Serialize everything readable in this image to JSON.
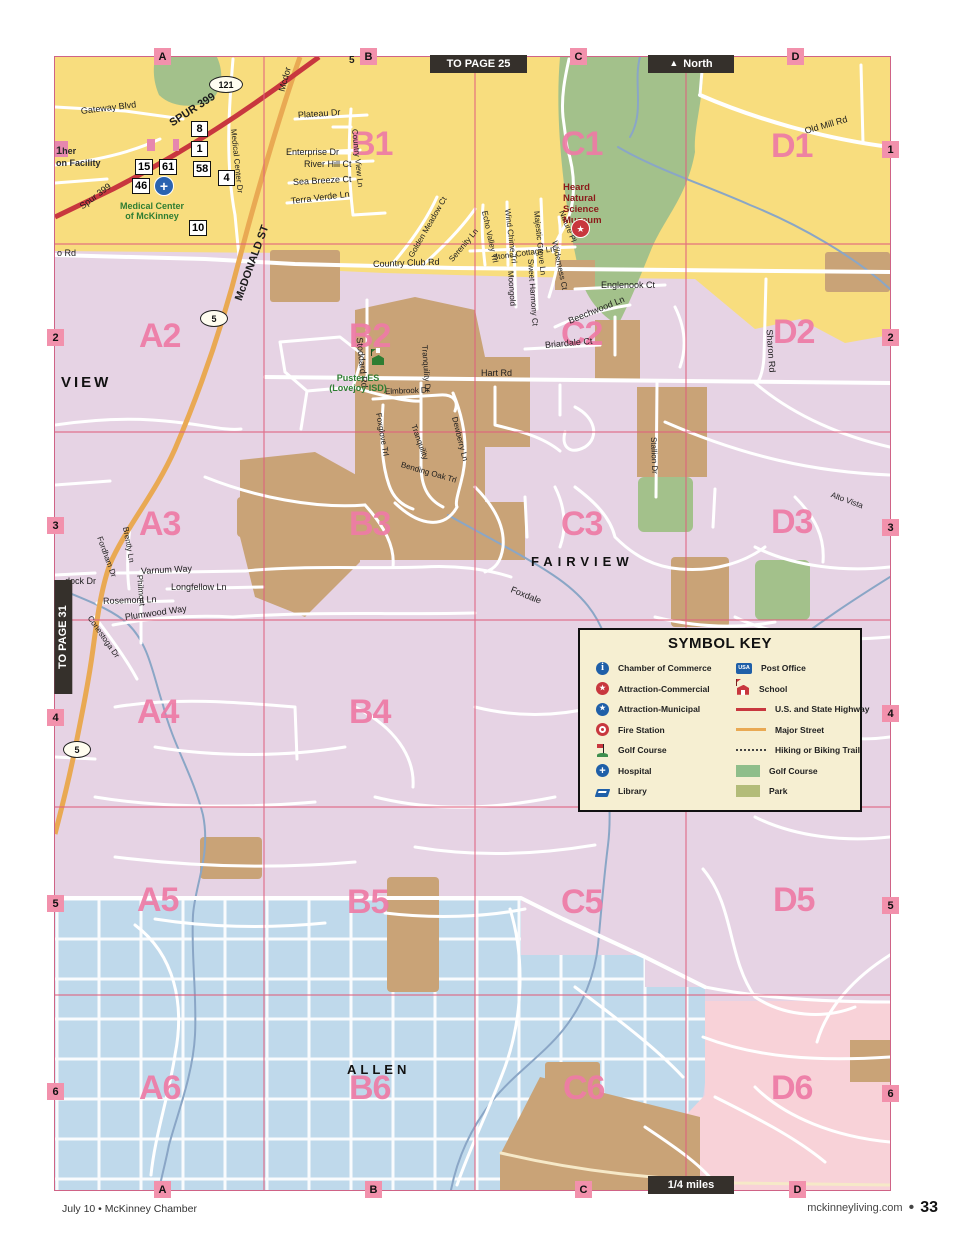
{
  "nav": {
    "to_page_top": "TO PAGE 25",
    "north_arrow": "▲",
    "north_label": "North",
    "to_page_left": "TO PAGE 31",
    "scale_label": "1/4 miles"
  },
  "footer": {
    "left": "July 10 • McKinney Chamber",
    "site": "mckinneyliving.com",
    "bullet": "•",
    "page": "33"
  },
  "colors": {
    "yellow": "#F8DD7E",
    "lavender": "#E6D3E4",
    "blue": "#BFD9EB",
    "pink": "#F8D2D8",
    "tan": "#C9A377",
    "green": "#A3C18B",
    "highway_red": "#C8373E",
    "street_orange": "#E9A953",
    "grid_pink": "#F291AC",
    "cell_label": "#EE7BA6",
    "creek": "#8AA6C6",
    "grid_line": "#E0607E"
  },
  "grid": {
    "top_letters": [
      {
        "t": "A",
        "x": 99
      },
      {
        "t": "B",
        "x": 305
      },
      {
        "t": "C",
        "x": 515
      },
      {
        "t": "D",
        "x": 732
      }
    ],
    "bottom_letters": [
      {
        "t": "A",
        "x": 99
      },
      {
        "t": "B",
        "x": 310
      },
      {
        "t": "C",
        "x": 520
      },
      {
        "t": "D",
        "x": 734
      }
    ],
    "left_numbers": [
      {
        "t": "2",
        "y": 272
      },
      {
        "t": "3",
        "y": 460
      },
      {
        "t": "4",
        "y": 652
      },
      {
        "t": "5",
        "y": 838
      },
      {
        "t": "6",
        "y": 1026
      }
    ],
    "right_numbers": [
      {
        "t": "1",
        "y": 84
      },
      {
        "t": "2",
        "y": 272
      },
      {
        "t": "3",
        "y": 462
      },
      {
        "t": "4",
        "y": 648
      },
      {
        "t": "5",
        "y": 840
      },
      {
        "t": "6",
        "y": 1028
      }
    ]
  },
  "cells": [
    {
      "t": "B1",
      "x": 296,
      "y": 70
    },
    {
      "t": "C1",
      "x": 506,
      "y": 70
    },
    {
      "t": "D1",
      "x": 716,
      "y": 72
    },
    {
      "t": "A2",
      "x": 84,
      "y": 262
    },
    {
      "t": "B2",
      "x": 294,
      "y": 262
    },
    {
      "t": "C2",
      "x": 506,
      "y": 260
    },
    {
      "t": "D2",
      "x": 718,
      "y": 258
    },
    {
      "t": "A3",
      "x": 84,
      "y": 450
    },
    {
      "t": "B3",
      "x": 294,
      "y": 450
    },
    {
      "t": "C3",
      "x": 506,
      "y": 450
    },
    {
      "t": "D3",
      "x": 716,
      "y": 448
    },
    {
      "t": "A4",
      "x": 82,
      "y": 638
    },
    {
      "t": "B4",
      "x": 294,
      "y": 638
    },
    {
      "t": "A5",
      "x": 82,
      "y": 826
    },
    {
      "t": "B5",
      "x": 292,
      "y": 828
    },
    {
      "t": "C5",
      "x": 506,
      "y": 828
    },
    {
      "t": "D5",
      "x": 718,
      "y": 826
    },
    {
      "t": "A6",
      "x": 84,
      "y": 1014
    },
    {
      "t": "B6",
      "x": 294,
      "y": 1014
    },
    {
      "t": "C6",
      "x": 508,
      "y": 1014
    },
    {
      "t": "D6",
      "x": 716,
      "y": 1014
    }
  ],
  "cities": [
    {
      "t": "VIEW",
      "x": 6,
      "y": 318,
      "s": 15,
      "ls": 3
    },
    {
      "t": "FAIRVIEW",
      "x": 476,
      "y": 498,
      "s": 13,
      "ls": 5
    },
    {
      "t": "ALLEN",
      "x": 292,
      "y": 1006,
      "s": 13,
      "ls": 4
    }
  ],
  "streets": [
    {
      "t": "Gateway Blvd",
      "x": 26,
      "y": 50,
      "r": -7,
      "s": 9
    },
    {
      "t": "Spur 399",
      "x": 26,
      "y": 146,
      "r": -37,
      "s": 9
    },
    {
      "t": "SPUR 399",
      "x": 116,
      "y": 62,
      "r": -33,
      "s": 11,
      "b": 1
    },
    {
      "t": "Mcdor",
      "x": 227,
      "y": 30,
      "r": -75,
      "s": 9
    },
    {
      "t": "Plateau Dr",
      "x": 243,
      "y": 54,
      "r": -4,
      "s": 9
    },
    {
      "t": "Enterprise Dr",
      "x": 231,
      "y": 91,
      "s": 9
    },
    {
      "t": "River Hill Ct",
      "x": 249,
      "y": 103,
      "s": 9
    },
    {
      "t": "Sea Breeze Ct",
      "x": 238,
      "y": 121,
      "r": -3,
      "s": 9
    },
    {
      "t": "Terra Verde Ln",
      "x": 236,
      "y": 140,
      "r": -7,
      "s": 9
    },
    {
      "t": "Country View Ln",
      "x": 299,
      "y": 68,
      "r": 84
    },
    {
      "t": "Golden Meadow Ct",
      "x": 356,
      "y": 196,
      "r": -60
    },
    {
      "t": "Serenity Ln",
      "x": 396,
      "y": 200,
      "r": -50
    },
    {
      "t": "Echo Valley Trl",
      "x": 429,
      "y": 150,
      "r": 78
    },
    {
      "t": "Stone Cottage Ln",
      "x": 438,
      "y": 197,
      "r": -8
    },
    {
      "t": "Wind Chime Trl",
      "x": 452,
      "y": 148,
      "r": 83
    },
    {
      "t": "Moongold",
      "x": 455,
      "y": 210,
      "r": 86
    },
    {
      "t": "Sweet Harmony Ct",
      "x": 475,
      "y": 198,
      "r": 86
    },
    {
      "t": "Majestic Grove Ln",
      "x": 481,
      "y": 150,
      "r": 84
    },
    {
      "t": "Wilderness Ct",
      "x": 499,
      "y": 180,
      "r": 78
    },
    {
      "t": "Nature Pl",
      "x": 506,
      "y": 150,
      "r": 68
    },
    {
      "t": "Country Club Rd",
      "x": 318,
      "y": 203,
      "r": -2,
      "s": 9
    },
    {
      "t": "o Rd",
      "x": 2,
      "y": 192,
      "s": 9
    },
    {
      "t": "Englenook Ct",
      "x": 546,
      "y": 224,
      "s": 9
    },
    {
      "t": "Beechwood Ln",
      "x": 514,
      "y": 260,
      "r": -22,
      "s": 9
    },
    {
      "t": "Briardale Ct",
      "x": 490,
      "y": 284,
      "r": -5,
      "s": 9
    },
    {
      "t": "Old Mill Rd",
      "x": 750,
      "y": 70,
      "r": -16,
      "s": 9
    },
    {
      "t": "Sharon Rd",
      "x": 714,
      "y": 268,
      "r": 86,
      "s": 9
    },
    {
      "t": "Stoddard Rd",
      "x": 304,
      "y": 276,
      "r": 84,
      "s": 9
    },
    {
      "t": "Hart Rd",
      "x": 426,
      "y": 312,
      "s": 9
    },
    {
      "t": "Elmbrook Dr",
      "x": 330,
      "y": 331,
      "r": -2
    },
    {
      "t": "Tranquility Dr",
      "x": 369,
      "y": 284,
      "r": 86
    },
    {
      "t": "Tranquility",
      "x": 358,
      "y": 364,
      "r": 70
    },
    {
      "t": "Foxglove Trl",
      "x": 323,
      "y": 352,
      "r": 80
    },
    {
      "t": "Bending Oak Trl",
      "x": 346,
      "y": 404,
      "r": 16
    },
    {
      "t": "Dewberry Ln",
      "x": 399,
      "y": 356,
      "r": 76
    },
    {
      "t": "Stallion Dr",
      "x": 598,
      "y": 376,
      "r": 88
    },
    {
      "t": "Alto Vista",
      "x": 776,
      "y": 434,
      "r": 20
    },
    {
      "t": "Fordham Dr",
      "x": 44,
      "y": 476,
      "r": 70
    },
    {
      "t": "Brently Ln",
      "x": 70,
      "y": 466,
      "r": 80
    },
    {
      "t": "Varnum Way",
      "x": 86,
      "y": 510,
      "r": -3,
      "s": 9
    },
    {
      "t": "dock Dr",
      "x": 10,
      "y": 520,
      "s": 9
    },
    {
      "t": "Longfellow Ln",
      "x": 116,
      "y": 526,
      "s": 9
    },
    {
      "t": "Rosemont Ln",
      "x": 48,
      "y": 540,
      "r": -2,
      "s": 9
    },
    {
      "t": "Philmont",
      "x": 84,
      "y": 514,
      "r": 85
    },
    {
      "t": "Conestoga Dr",
      "x": 34,
      "y": 556,
      "r": 55
    },
    {
      "t": "Plumwood Way",
      "x": 70,
      "y": 556,
      "r": -8,
      "s": 9
    },
    {
      "t": "Foxdale",
      "x": 456,
      "y": 528,
      "r": 22,
      "s": 9
    },
    {
      "t": "McDONALD ST",
      "x": 184,
      "y": 238,
      "r": -70,
      "s": 11,
      "b": 1
    },
    {
      "t": "Medical Center Dr",
      "x": 178,
      "y": 68,
      "r": 84
    },
    {
      "t": "5",
      "x": 294,
      "y": -1,
      "s": 10,
      "b": 1
    }
  ],
  "badges": [
    {
      "n": "8",
      "x": 136,
      "y": 64
    },
    {
      "n": "1",
      "x": 136,
      "y": 84
    },
    {
      "n": "15",
      "x": 80,
      "y": 102
    },
    {
      "n": "61",
      "x": 104,
      "y": 102
    },
    {
      "n": "58",
      "x": 138,
      "y": 104
    },
    {
      "n": "4",
      "x": 163,
      "y": 113
    },
    {
      "n": "46",
      "x": 77,
      "y": 121
    },
    {
      "n": "10",
      "x": 134,
      "y": 163
    }
  ],
  "shields": [
    {
      "n": "121",
      "x": 154,
      "y": 19,
      "w": 32
    },
    {
      "n": "5",
      "x": 145,
      "y": 253,
      "w": 26
    },
    {
      "n": "5",
      "x": 8,
      "y": 684,
      "w": 26
    }
  ],
  "pois": {
    "medical": {
      "l1": "Medical Center",
      "l2": "of McKinney"
    },
    "puster": {
      "l1": "Puster ES",
      "l2": "(Lovejoy ISD)"
    },
    "heard": {
      "l1": "Heard",
      "l2": "Natural",
      "l3": "Science",
      "l4": "Museum"
    },
    "facility": {
      "num": "1",
      "l1": "her",
      "l2": "on Facility"
    }
  },
  "icons": {
    "hospital_glyph": "+",
    "star_glyph": "★"
  },
  "legend": {
    "title": "SYMBOL KEY",
    "left": [
      {
        "icon": "chamber",
        "glyph": "i",
        "label": "Chamber of Commerce"
      },
      {
        "icon": "attraction-commercial",
        "glyph": "★",
        "label": "Attraction-Commercial"
      },
      {
        "icon": "attraction-municipal",
        "glyph": "★",
        "label": "Attraction-Municipal"
      },
      {
        "icon": "fire",
        "label": "Fire Station"
      },
      {
        "icon": "golf-flag",
        "label": "Golf Course"
      },
      {
        "icon": "hospital",
        "glyph": "+",
        "label": "Hospital"
      },
      {
        "icon": "library",
        "label": "Library"
      }
    ],
    "right": [
      {
        "icon": "post-office",
        "glyph": "USA",
        "label": "Post Office"
      },
      {
        "icon": "school",
        "label": "School"
      },
      {
        "icon": "highway-line",
        "label": "U.S. and State Highway"
      },
      {
        "icon": "street-line",
        "label": "Major Street"
      },
      {
        "icon": "trail-line",
        "label": "Hiking or Biking Trail"
      },
      {
        "icon": "golf-swatch",
        "label": "Golf Course"
      },
      {
        "icon": "park-swatch",
        "label": "Park"
      }
    ]
  }
}
